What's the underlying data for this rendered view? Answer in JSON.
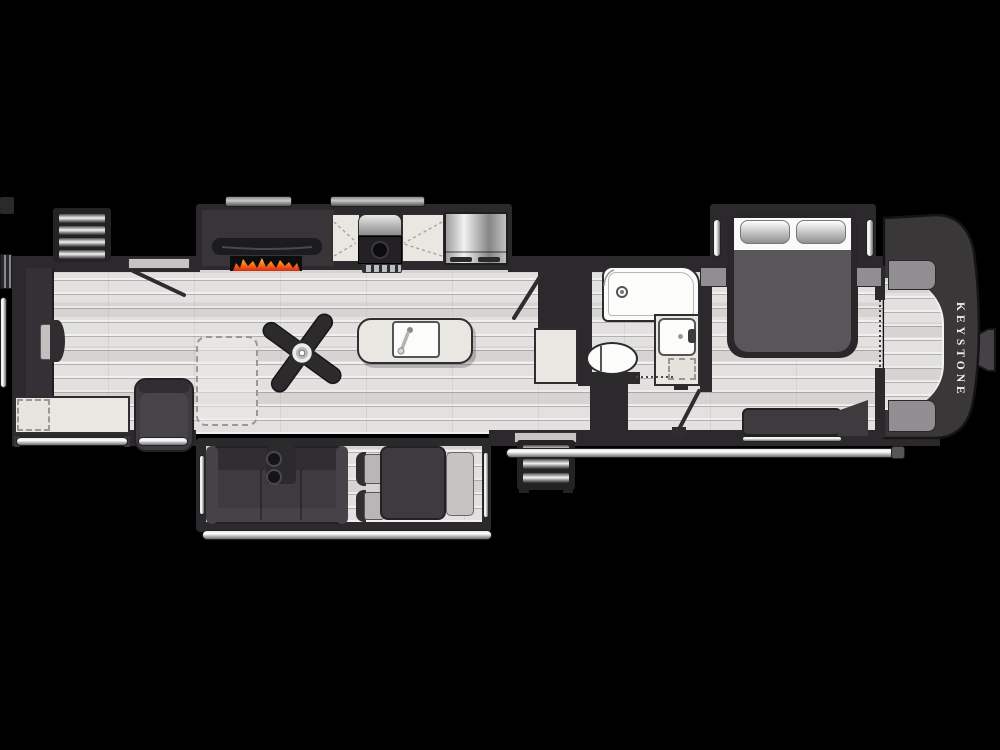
{
  "window": {
    "width": 1000,
    "height": 750,
    "background": "#000000"
  },
  "brand": {
    "label": "KEYSTONE"
  },
  "colors": {
    "background": "#000000",
    "wall": "#2b292c",
    "floor": "#dcdbd9",
    "counter": "#e9e7e1",
    "furniture": "#3e3b3f",
    "fixture": "#fcfcfb",
    "brand_text": "#f2f1ef",
    "flame_orange": "#ff7a1a",
    "flame_red": "#d42a12",
    "flame_yellow": "#ffd24a",
    "metal_light": "#f2f2f2"
  },
  "floorplan": {
    "type": "rv-fifth-wheel-top-view",
    "features": [
      "rear-entry-steps",
      "rear-entry-door",
      "desk",
      "desk-chair",
      "rear-counter",
      "optional-appliance-dashed",
      "recliner",
      "optional-furniture-dashed",
      "entertainment-center",
      "tv",
      "fireplace",
      "kitchen-counter",
      "range-stove",
      "refrigerator",
      "kitchen-island-sink",
      "ceiling-fan",
      "sofa-with-cupholders",
      "dinette-table",
      "dinette-chairs",
      "dinette-bench",
      "main-entry-steps",
      "main-entry-door",
      "pantry",
      "shower",
      "toilet",
      "vanity-sink",
      "pocket-door",
      "bedroom-door",
      "queen-bed",
      "pillows",
      "nightstands",
      "bedroom-bench",
      "wardrobe-sliding-doors",
      "front-closet",
      "closet-shelves",
      "front-cap",
      "hitch-pin",
      "awning-rail",
      "slide-out-toppers"
    ]
  }
}
